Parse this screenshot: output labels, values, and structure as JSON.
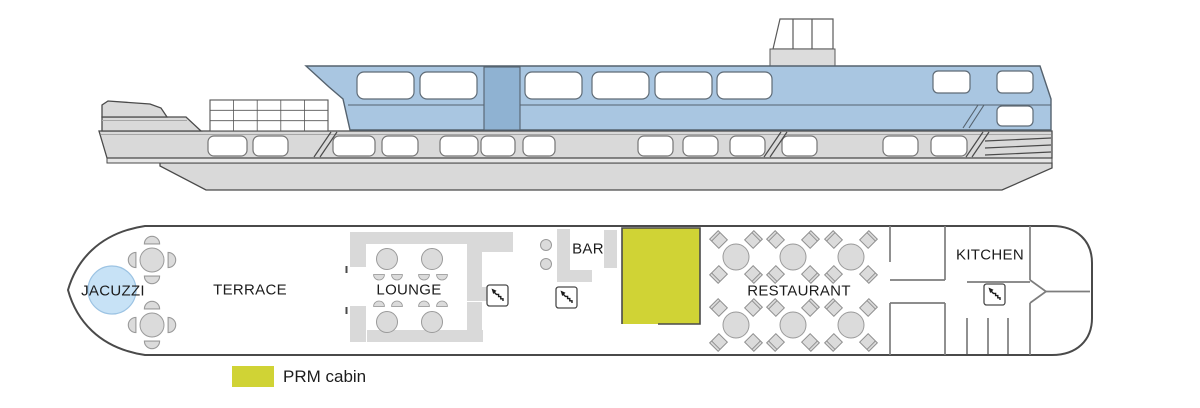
{
  "colors": {
    "superstructure_blue": "#a9c6e1",
    "pillar_blue": "#8fb2d2",
    "jacuzzi_blue": "#c7e2f6",
    "prm_cabin_yellow": "#d0d335",
    "hull_gray": "#d9d9d9",
    "wall_gray": "#7d7d7d",
    "outline_dark": "#4a4a4a",
    "text": "#1c1c1c"
  },
  "deck_plan": {
    "labels": {
      "jacuzzi": "JACUZZI",
      "terrace": "TERRACE",
      "lounge": "LOUNGE",
      "bar": "BAR",
      "restaurant": "RESTAURANT",
      "kitchen": "KITCHEN"
    },
    "furniture": {
      "terrace_table_groups": 2,
      "lounge_tables": 4,
      "restaurant_tables": 6,
      "bar_stools": 2,
      "stairs_icons": 3
    }
  },
  "legend": {
    "items": [
      {
        "label": "PRM cabin",
        "color": "#d0d335"
      }
    ]
  }
}
